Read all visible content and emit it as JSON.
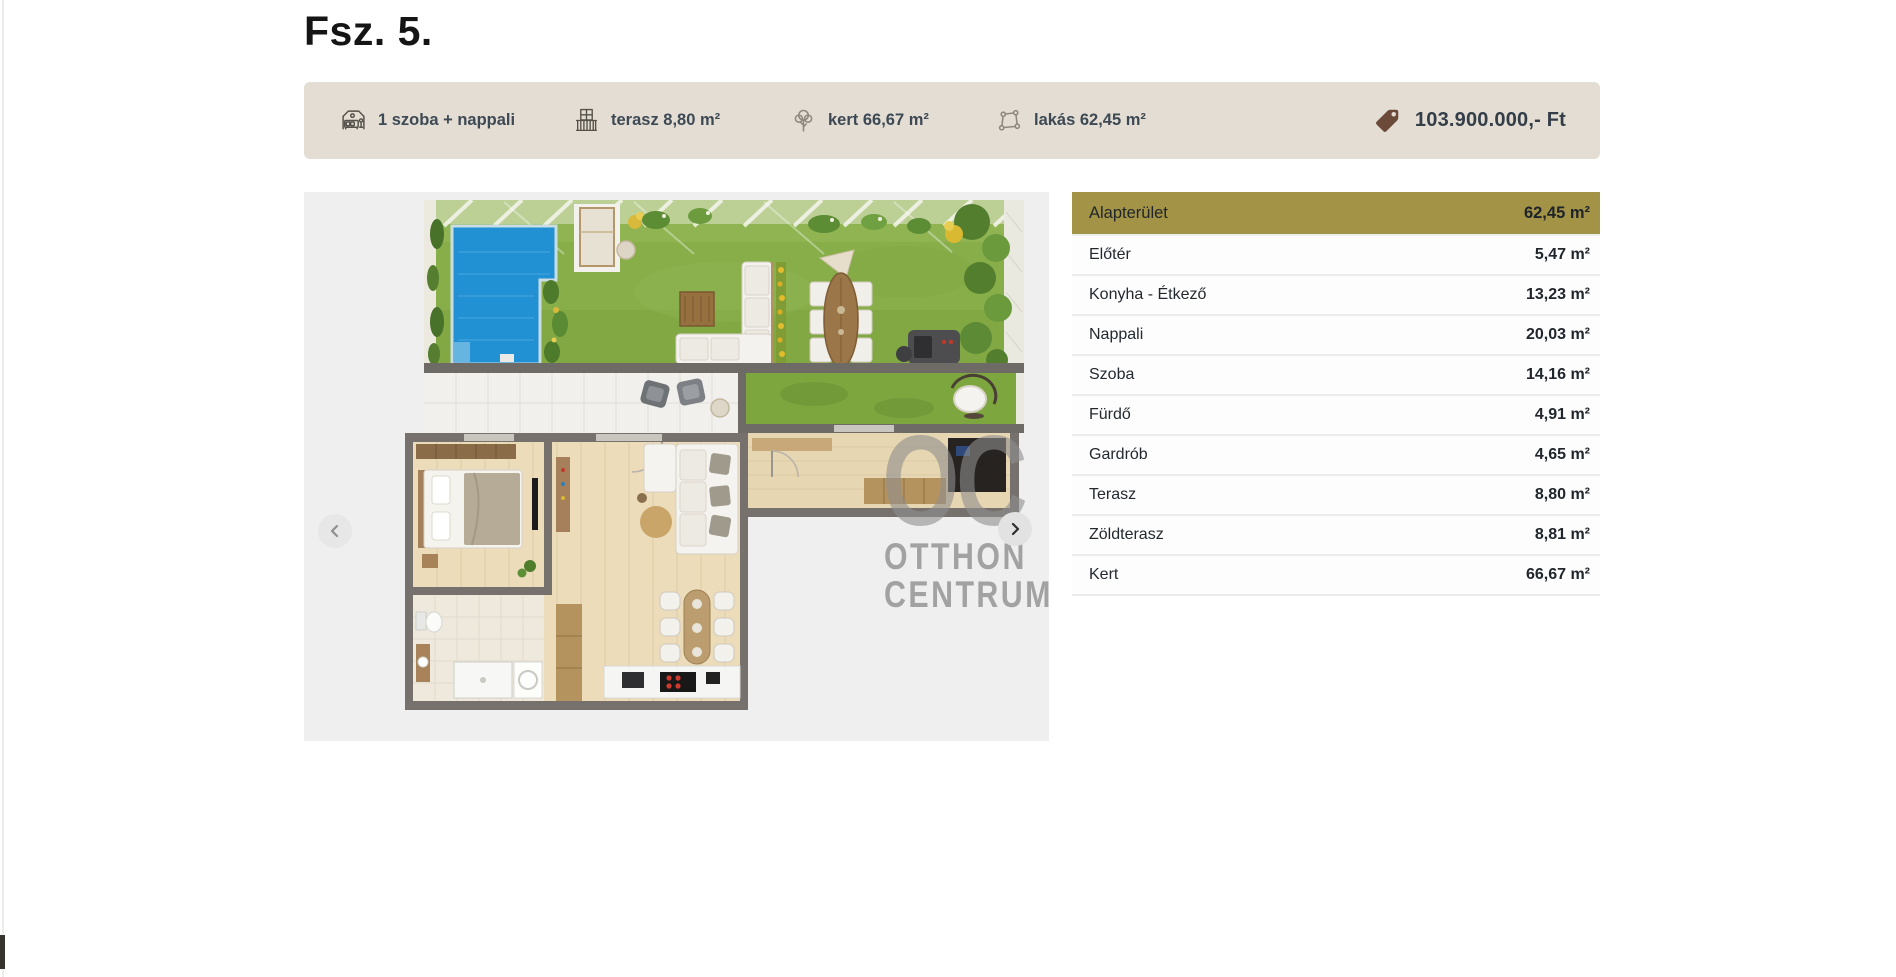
{
  "page": {
    "title": "Fsz. 5."
  },
  "summary_bar": {
    "items": [
      {
        "icon": "bedroom-icon",
        "label": "1 szoba + nappali"
      },
      {
        "icon": "balcony-icon",
        "label": "terasz 8,80 m²"
      },
      {
        "icon": "tree-icon",
        "label": "kert 66,67 m²"
      },
      {
        "icon": "area-icon",
        "label": "lakás 62,45 m²"
      }
    ],
    "price": "103.900.000,- Ft"
  },
  "gallery": {
    "watermark": {
      "logo": "OC",
      "line1": "OTTHON",
      "line2": "CENTRUM"
    }
  },
  "area_table": {
    "header": {
      "label": "Alapterület",
      "value": "62,45 m²"
    },
    "rows": [
      {
        "label": "Előtér",
        "value": "5,47 m²"
      },
      {
        "label": "Konyha - Étkező",
        "value": "13,23 m²"
      },
      {
        "label": "Nappali",
        "value": "20,03 m²"
      },
      {
        "label": "Szoba",
        "value": "14,16 m²"
      },
      {
        "label": "Fürdő",
        "value": "4,91 m²"
      },
      {
        "label": "Gardrób",
        "value": "4,65 m²"
      },
      {
        "label": "Terasz",
        "value": "8,80 m²"
      },
      {
        "label": "Zöldterasz",
        "value": "8,81 m²"
      },
      {
        "label": "Kert",
        "value": "66,67 m²"
      }
    ]
  },
  "colors": {
    "accent_olive": "#a39346",
    "bar_background": "#e4ddd3",
    "price_tag_brown": "#6b4a39",
    "pool_blue": "#2191d3",
    "grass_green": "#88ae4a",
    "carousel_background": "#efefef"
  }
}
